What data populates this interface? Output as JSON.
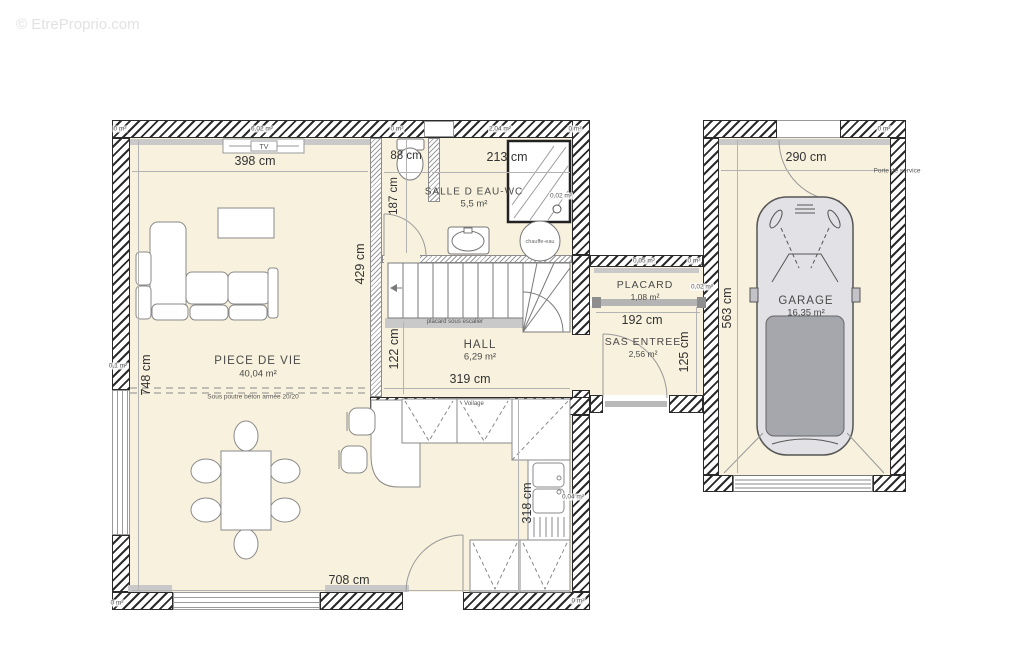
{
  "watermark": {
    "corner": "© EtreProprio.com",
    "center": "EtreProprio.com"
  },
  "rooms": {
    "piece_de_vie": {
      "name": "PIECE DE VIE",
      "area": "40,04 m²"
    },
    "salle_eau": {
      "name": "SALLE D EAU-WC",
      "area": "5,5 m²"
    },
    "hall": {
      "name": "HALL",
      "area": "6,29 m²"
    },
    "placard": {
      "name": "PLACARD",
      "area": "1,08 m²"
    },
    "sas": {
      "name": "SAS ENTREE",
      "area": "2,56 m²"
    },
    "garage": {
      "name": "GARAGE",
      "area": "16,35 m²"
    }
  },
  "dims": {
    "living_top": "398 cm",
    "bath_left": "88 cm",
    "bath_right": "213 cm",
    "garage_width": "290 cm",
    "bath_height": "187 cm",
    "living_right": "429 cm",
    "hall_left": "122 cm",
    "hall_width": "319 cm",
    "placard_width": "192 cm",
    "garage_height": "563 cm",
    "sas_height": "125 cm",
    "living_height": "748 cm",
    "kitchen_height": "318 cm",
    "living_bottom": "708 cm"
  },
  "labels": {
    "under_stairs": "placard sous escalier",
    "beam": "Sous poutre béton armée 20/20",
    "service_door": "Porte de service",
    "glazing": "Voilage",
    "water_heater": "chauffe-eau",
    "tv": "TV"
  },
  "area_marks": {
    "m1": "0 m²",
    "m2": "6,02 m²",
    "m3": "0 m²",
    "m4": "2,04 m²",
    "m5": "0 m²",
    "m6": "0,02 m²",
    "m7": "0,05 m²",
    "m8": "0 m²",
    "m9": "0,02 m²",
    "m10": "0,04 m²",
    "m11": "0,1 m²",
    "m12": "0 m²",
    "m13": "0 m²",
    "m14": "0 m²"
  },
  "colors": {
    "floor": "#f8f1dd",
    "wall": "#2b2b2b",
    "sill": "#c9c9c9",
    "car_roof": "#a6a6ad"
  }
}
